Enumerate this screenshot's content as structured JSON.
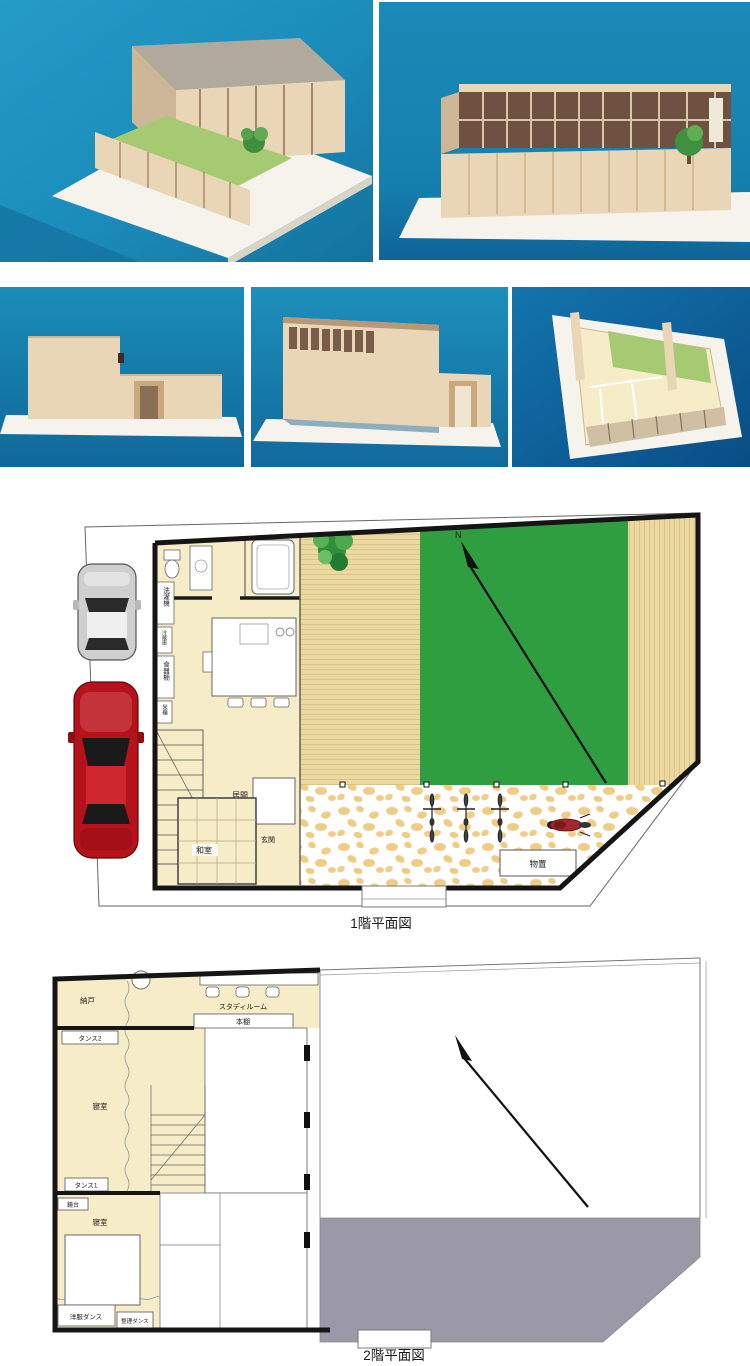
{
  "colors": {
    "photo_blue": "#1b8cba",
    "photo_blue_deep": "#10659c",
    "photo_blue_dark": "#0f63a4",
    "base_white": "#f5f3ec",
    "model_wood": "#e8d6b6",
    "model_wood_shade": "#cdb796",
    "model_roof": "#b0a99c",
    "model_glass": "#6e5140",
    "model_lawn": "#a6ca71",
    "plan_cream": "#f6ecc8",
    "deck_tan": "#ecd9a0",
    "deck_stripe": "#d8c187",
    "lawn_green": "#2e9e41",
    "stone_tan": "#f0cd86",
    "roof_gray": "#9b99a8",
    "wall_black": "#151515",
    "line_gray": "#777777",
    "car_red": "#b5121b",
    "car_silver": "#cfcfcf"
  },
  "photos": {
    "count": 5,
    "items": [
      {
        "bg": "#1b8cba"
      },
      {
        "bg": "#1580ae"
      },
      {
        "bg": "#1585b2"
      },
      {
        "bg": "#1a87b5"
      },
      {
        "bg": "#0f63a4"
      }
    ]
  },
  "floor1": {
    "caption": "1階平面図",
    "compass_label": "N",
    "labels": {
      "washer": "洗濯機",
      "fridge": "冷蔵庫",
      "cupboard": "食器棚",
      "rice_bin": "米櫃",
      "living": "居間",
      "tatami": "和室",
      "entrance": "玄関",
      "shed": "物置"
    }
  },
  "floor2": {
    "caption": "2階平面図",
    "labels": {
      "storeroom": "納戸",
      "study": "スタディルーム",
      "bookshelf": "本棚",
      "dresser2": "タンス2",
      "bedroom1": "寝室",
      "dresser1": "タンス1",
      "mirror_stand": "鏡台",
      "bedroom2": "寝室",
      "wardrobe": "洋服ダンス",
      "chest": "整理ダンス"
    }
  }
}
